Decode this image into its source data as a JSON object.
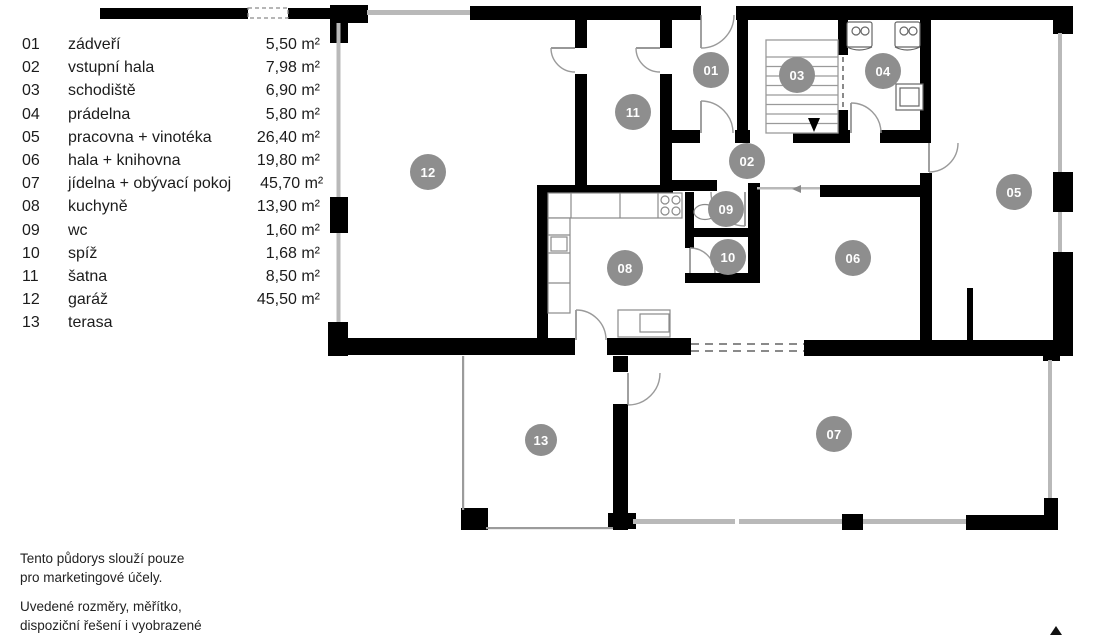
{
  "legend": {
    "rooms": [
      {
        "num": "01",
        "name": "zádveří",
        "area": "5,50 m²"
      },
      {
        "num": "02",
        "name": "vstupní hala",
        "area": "7,98 m²"
      },
      {
        "num": "03",
        "name": "schodiště",
        "area": "6,90 m²"
      },
      {
        "num": "04",
        "name": "prádelna",
        "area": "5,80 m²"
      },
      {
        "num": "05",
        "name": "pracovna + vinotéka",
        "area": "26,40 m²"
      },
      {
        "num": "06",
        "name": "hala + knihovna",
        "area": "19,80 m²"
      },
      {
        "num": "07",
        "name": "jídelna + obývací pokoj",
        "area": "45,70 m²"
      },
      {
        "num": "08",
        "name": "kuchyně",
        "area": "13,90 m²"
      },
      {
        "num": "09",
        "name": "wc",
        "area": "1,60 m²"
      },
      {
        "num": "10",
        "name": "spíž",
        "area": "1,68 m²"
      },
      {
        "num": "11",
        "name": "šatna",
        "area": "8,50 m²"
      },
      {
        "num": "12",
        "name": "garáž",
        "area": "45,50 m²"
      },
      {
        "num": "13",
        "name": "terasa",
        "area": ""
      }
    ]
  },
  "plan": {
    "marker_color": "#8e8e8e",
    "markers": [
      {
        "id": "01",
        "x": 711,
        "y": 70,
        "r": 18
      },
      {
        "id": "02",
        "x": 747,
        "y": 161,
        "r": 18
      },
      {
        "id": "03",
        "x": 797,
        "y": 75,
        "r": 18
      },
      {
        "id": "04",
        "x": 883,
        "y": 71,
        "r": 18
      },
      {
        "id": "05",
        "x": 1014,
        "y": 192,
        "r": 18
      },
      {
        "id": "06",
        "x": 853,
        "y": 258,
        "r": 18
      },
      {
        "id": "07",
        "x": 834,
        "y": 434,
        "r": 18
      },
      {
        "id": "08",
        "x": 625,
        "y": 268,
        "r": 18
      },
      {
        "id": "09",
        "x": 726,
        "y": 209,
        "r": 18
      },
      {
        "id": "10",
        "x": 728,
        "y": 257,
        "r": 18
      },
      {
        "id": "11",
        "x": 633,
        "y": 112,
        "r": 18
      },
      {
        "id": "12",
        "x": 428,
        "y": 172,
        "r": 18
      },
      {
        "id": "13",
        "x": 541,
        "y": 440,
        "r": 16
      }
    ]
  },
  "disclaimer": {
    "paragraphs": [
      [
        "Tento půdorys slouží pouze",
        "pro marketingové účely."
      ],
      [
        "Uvedené rozměry, měřítko,",
        "dispoziční řešení i vyobrazené",
        "zařízení jsou pouze ilustrativní."
      ]
    ]
  }
}
